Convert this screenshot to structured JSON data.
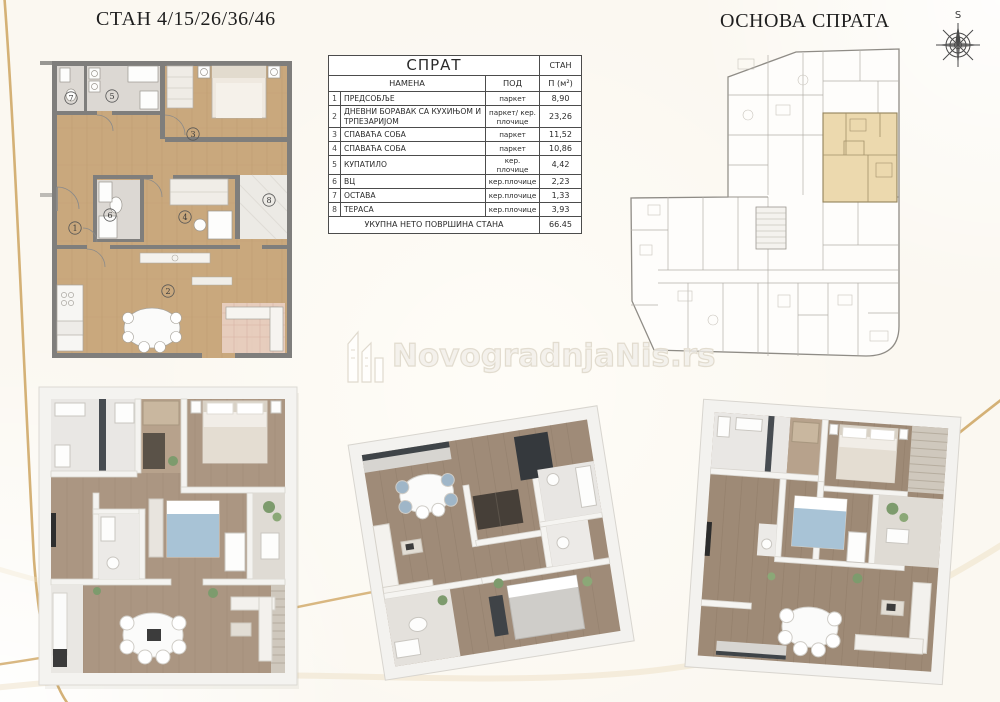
{
  "page": {
    "title_left": "СТАН 4/15/26/36/46",
    "title_right": "ОСНОВА СПРАТА",
    "compass_label": "S",
    "watermark": "NovogradnjaNis.rs",
    "background_color": "#fbf8f1",
    "accent_gold": "#cfa968",
    "highlight_unit_color": "#ecd9ae"
  },
  "table": {
    "header_left": "СПРАТ",
    "header_right": "СТАН",
    "col_name": "НАМЕНА",
    "col_floor": "ПОД",
    "col_area": "П (м²)",
    "rows": [
      {
        "no": "1",
        "name": "ПРЕДСОБЉЕ",
        "floor": "паркет",
        "area": "8,90"
      },
      {
        "no": "2",
        "name": "ДНЕВНИ БОРАВАК СА КУХИЊОМ И ТРПЕЗАРИЈОМ",
        "floor": "паркет/ кер. плочице",
        "area": "23,26"
      },
      {
        "no": "3",
        "name": "СПАВАЋА СОБА",
        "floor": "паркет",
        "area": "11,52"
      },
      {
        "no": "4",
        "name": "СПАВАЋА СОБА",
        "floor": "паркет",
        "area": "10,86"
      },
      {
        "no": "5",
        "name": "КУПАТИЛО",
        "floor": "кер. плочице",
        "area": "4,42"
      },
      {
        "no": "6",
        "name": "ВЦ",
        "floor": "кер.плочице",
        "area": "2,23"
      },
      {
        "no": "7",
        "name": "ОСТАВА",
        "floor": "кер.плочице",
        "area": "1,33"
      },
      {
        "no": "8",
        "name": "ТЕРАСА",
        "floor": "кер.плочице",
        "area": "3,93"
      }
    ],
    "footer_label": "УКУПНА НЕТО ПОВРШИНА СТАНА",
    "footer_value": "66.45"
  },
  "plan2d": {
    "room_numbers": [
      "1",
      "2",
      "3",
      "4",
      "5",
      "6",
      "7",
      "8"
    ]
  }
}
